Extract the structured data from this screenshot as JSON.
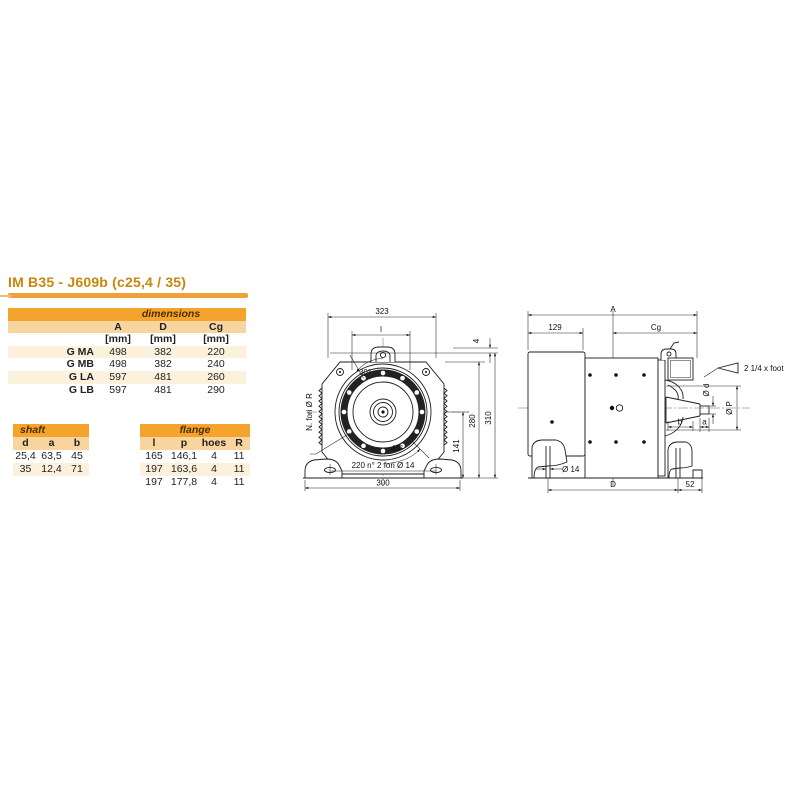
{
  "page": {
    "title": "IM B35 - J609b (c25,4 / 35)"
  },
  "colors": {
    "accent_orange": "#F4A42C",
    "subheader_tan": "#F8D49E",
    "row_cream": "#FCF1DC",
    "title_text": "#C8860D",
    "rule_orange": "#EFA23B"
  },
  "dimensions_table": {
    "title": "dimensions",
    "columns": [
      "A",
      "D",
      "Cg"
    ],
    "units": [
      "[mm]",
      "[mm]",
      "[mm]"
    ],
    "rows": [
      {
        "label": "G MA",
        "values": [
          "498",
          "382",
          "220"
        ]
      },
      {
        "label": "G MB",
        "values": [
          "498",
          "382",
          "240"
        ]
      },
      {
        "label": "G LA",
        "values": [
          "597",
          "481",
          "260"
        ]
      },
      {
        "label": "G LB",
        "values": [
          "597",
          "481",
          "290"
        ]
      }
    ]
  },
  "shaft_table": {
    "title": "shaft",
    "columns": [
      "d",
      "a",
      "b"
    ],
    "rows": [
      [
        "25,4",
        "63,5",
        "45"
      ],
      [
        "35",
        "12,4",
        "71"
      ]
    ]
  },
  "flange_table": {
    "title": "flange",
    "columns": [
      "l",
      "p",
      "hoes",
      "R"
    ],
    "rows": [
      [
        "165",
        "146,1",
        "4",
        "11"
      ],
      [
        "197",
        "163,6",
        "4",
        "11"
      ],
      [
        "197",
        "177,8",
        "4",
        "11"
      ]
    ]
  },
  "front_view": {
    "w_top": "323",
    "l": "l",
    "angle_top": "30°",
    "angle_bottom": "45°",
    "left_note": "N. fori Ø R",
    "top_gap": "4",
    "h_center": "141",
    "h_frame": "280",
    "h_total": "310",
    "feet_holes": "220 n° 2 fori Ø 14",
    "w_bottom": "300"
  },
  "side_view": {
    "total_len": "A",
    "left_len": "129",
    "cg": "Cg",
    "foot_note": "2 1/4 x foot",
    "shaft_d": "Ø d",
    "flange_p": "Ø P",
    "b": "b",
    "a": "a",
    "foot_hole": "Ø 14",
    "d_len": "D",
    "end_len": "52"
  }
}
